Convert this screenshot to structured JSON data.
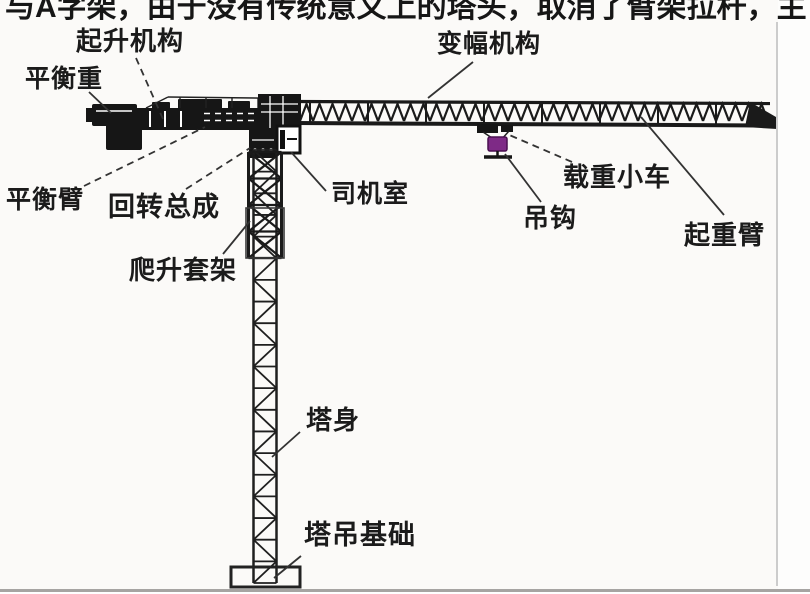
{
  "page": {
    "truncated_top_text": "与A字架，由于没有传统意义上的塔头，取消了臂架拉杆，主",
    "background": "#fbfaf8"
  },
  "diagram": {
    "type": "labeled-structure-diagram",
    "colors": {
      "diagram_ink": "#1a1a1a",
      "leader": "#333333",
      "hook_block": "#7e2a86",
      "hook_block_edge": "#4a1050",
      "page_edge_line": "#cccccc",
      "bottom_rule": "#a6a4a2"
    },
    "labels": [
      {
        "id": "hoisting-mechanism",
        "text": "起升机构",
        "x": 76,
        "y": 28,
        "size": 26,
        "leader": {
          "x1": 136,
          "y1": 58,
          "x2": 163,
          "y2": 119,
          "dashed": true
        }
      },
      {
        "id": "counterweight",
        "text": "平衡重",
        "x": 25,
        "y": 66,
        "size": 25,
        "leader": {
          "x1": 89,
          "y1": 92,
          "x2": 111,
          "y2": 113,
          "dashed": false
        }
      },
      {
        "id": "luffing-mechanism",
        "text": "变幅机构",
        "x": 437,
        "y": 31,
        "size": 25,
        "leader": {
          "x1": 473,
          "y1": 62,
          "x2": 428,
          "y2": 98,
          "dashed": false
        }
      },
      {
        "id": "counterweight-arm",
        "text": "平衡臂",
        "x": 6,
        "y": 187,
        "size": 25,
        "leader": {
          "x1": 84,
          "y1": 186,
          "x2": 205,
          "y2": 127,
          "dashed": true
        }
      },
      {
        "id": "slewing-assembly",
        "text": "回转总成",
        "x": 108,
        "y": 193,
        "size": 27,
        "leader": {
          "x1": 186,
          "y1": 189,
          "x2": 250,
          "y2": 148,
          "dashed": true
        }
      },
      {
        "id": "operator-cab",
        "text": "司机室",
        "x": 331,
        "y": 181,
        "size": 25,
        "leader": {
          "x1": 326,
          "y1": 191,
          "x2": 291,
          "y2": 152,
          "dashed": false
        }
      },
      {
        "id": "climbing-frame",
        "text": "爬升套架",
        "x": 129,
        "y": 257,
        "size": 26,
        "leader": {
          "x1": 223,
          "y1": 254,
          "x2": 250,
          "y2": 221,
          "dashed": false
        }
      },
      {
        "id": "load-trolley",
        "text": "载重小车",
        "x": 563,
        "y": 164,
        "size": 26,
        "leader": {
          "x1": 572,
          "y1": 162,
          "x2": 507,
          "y2": 134,
          "dashed": true
        }
      },
      {
        "id": "hook",
        "text": "吊钩",
        "x": 523,
        "y": 205,
        "size": 26,
        "leader": {
          "x1": 541,
          "y1": 202,
          "x2": 505,
          "y2": 154,
          "dashed": false
        }
      },
      {
        "id": "jib",
        "text": "起重臂",
        "x": 684,
        "y": 222,
        "size": 26,
        "leader": {
          "x1": 641,
          "y1": 117,
          "x2": 724,
          "y2": 215,
          "dashed": false
        }
      },
      {
        "id": "tower-body",
        "text": "塔身",
        "x": 306,
        "y": 407,
        "size": 26,
        "leader": {
          "x1": 300,
          "y1": 432,
          "x2": 272,
          "y2": 457,
          "dashed": false
        }
      },
      {
        "id": "tower-foundation",
        "text": "塔吊基础",
        "x": 304,
        "y": 521,
        "size": 27,
        "leader": {
          "x1": 301,
          "y1": 556,
          "x2": 274,
          "y2": 578,
          "dashed": false
        }
      }
    ]
  }
}
